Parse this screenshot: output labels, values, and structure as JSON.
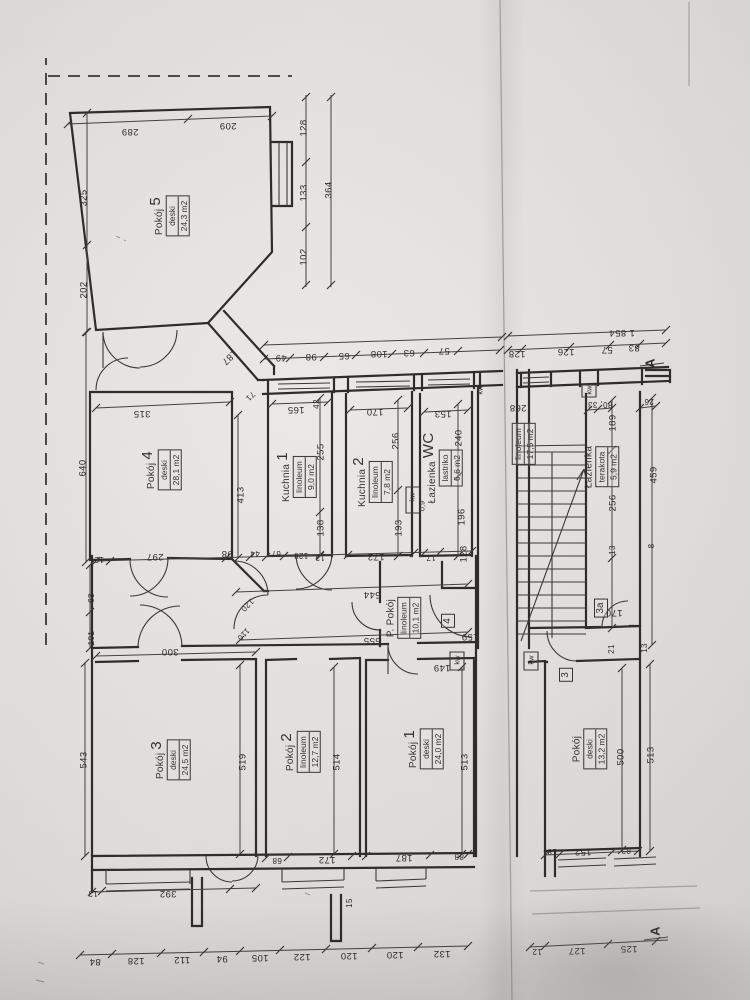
{
  "document": {
    "kind": "scanned apartment floor plan",
    "section_marker": "A",
    "total_length_label": "1 854",
    "ink_color": "#34322f",
    "paper_color": "#dbd9d7"
  },
  "rooms": [
    {
      "id": "pokoj-5",
      "name": "Pokój",
      "number": "5",
      "floor": "deski",
      "area": "24,3 m2",
      "x": 170,
      "y": 216
    },
    {
      "id": "pokoj-4",
      "name": "Pokój",
      "number": "4",
      "floor": "deski",
      "area": "28,1 m2",
      "x": 162,
      "y": 470
    },
    {
      "id": "kuchnia-1",
      "name": "Kuchnia",
      "number": "1",
      "floor": "linoleum",
      "area": "9,0 m2",
      "x": 297,
      "y": 477
    },
    {
      "id": "kuchnia-2",
      "name": "Kuchnia",
      "number": "2",
      "floor": "linoleum",
      "area": "7,8 m2",
      "x": 373,
      "y": 482
    },
    {
      "id": "lazienka-wc",
      "name": "Łazienka",
      "number": "WC",
      "floor": "lastriko",
      "area": "6,6 m2",
      "x": 443,
      "y": 468
    },
    {
      "id": "p-pokoj",
      "name": "P. Pokój",
      "number": "",
      "floor": "linoleum",
      "area": "10,1 m2",
      "x": 404,
      "y": 618
    },
    {
      "id": "pokoj-3",
      "name": "Pokój",
      "number": "3",
      "floor": "deski",
      "area": "24,5 m2",
      "x": 171,
      "y": 760
    },
    {
      "id": "pokoj-2",
      "name": "Pokój",
      "number": "2",
      "floor": "linoleum",
      "area": "12,7 m2",
      "x": 301,
      "y": 752
    },
    {
      "id": "pokoj-1",
      "name": "Pokój",
      "number": "1",
      "floor": "deski",
      "area": "24,0 m2",
      "x": 424,
      "y": 749
    },
    {
      "id": "klatka",
      "name": "",
      "number": "",
      "floor": "linoleum",
      "area": "17,5 m2",
      "x": 524,
      "y": 444
    },
    {
      "id": "lazienka-terakota",
      "name": "Łazienka",
      "number": "",
      "floor": "terakota",
      "area": "5,9 m2",
      "x": 602,
      "y": 467
    },
    {
      "id": "pokoj-parter",
      "name": "Pokój",
      "number": "",
      "floor": "deski",
      "area": "13,2 m2",
      "x": 590,
      "y": 749
    }
  ],
  "unit_markers": [
    {
      "t": "4",
      "x": 448,
      "y": 621
    },
    {
      "t": "3",
      "x": 566,
      "y": 675
    },
    {
      "t": "3a",
      "x": 601,
      "y": 608
    }
  ],
  "section_markers": [
    {
      "t": "A",
      "x": 650,
      "y": 363
    },
    {
      "t": "A",
      "x": 655,
      "y": 931
    }
  ],
  "shaft_labels": [
    {
      "t": "kw",
      "x": 412,
      "y": 497
    },
    {
      "t": "0,9",
      "x": 422,
      "y": 506
    },
    {
      "t": "kw",
      "x": 480,
      "y": 390
    },
    {
      "t": "kw",
      "x": 457,
      "y": 660
    },
    {
      "t": "kw",
      "x": 531,
      "y": 660
    },
    {
      "t": "kw",
      "x": 589,
      "y": 390
    }
  ],
  "dims": [
    {
      "t": "289",
      "x": 130,
      "y": 131,
      "o": "u"
    },
    {
      "t": "209",
      "x": 228,
      "y": 125,
      "o": "u"
    },
    {
      "t": "128",
      "x": 304,
      "y": 128,
      "o": "v"
    },
    {
      "t": "133",
      "x": 304,
      "y": 193,
      "o": "v"
    },
    {
      "t": "102",
      "x": 304,
      "y": 257,
      "o": "v"
    },
    {
      "t": "364",
      "x": 329,
      "y": 190,
      "o": "v"
    },
    {
      "t": "325",
      "x": 84,
      "y": 198,
      "o": "v"
    },
    {
      "t": "202",
      "x": 84,
      "y": 290,
      "o": "v"
    },
    {
      "t": "315",
      "x": 142,
      "y": 413,
      "o": "u"
    },
    {
      "t": "640",
      "x": 83,
      "y": 468,
      "o": "v"
    },
    {
      "t": "413",
      "x": 241,
      "y": 495,
      "o": "v"
    },
    {
      "t": "187",
      "x": 229,
      "y": 357,
      "o": "d"
    },
    {
      "t": "71",
      "x": 250,
      "y": 396,
      "o": "d",
      "s": 1
    },
    {
      "t": "297",
      "x": 155,
      "y": 556,
      "o": "u"
    },
    {
      "t": "98",
      "x": 227,
      "y": 553,
      "o": "u"
    },
    {
      "t": "12",
      "x": 99,
      "y": 559,
      "o": "u",
      "s": 1
    },
    {
      "t": "49",
      "x": 281,
      "y": 357,
      "o": "u"
    },
    {
      "t": "98",
      "x": 311,
      "y": 356,
      "o": "u"
    },
    {
      "t": "65",
      "x": 344,
      "y": 355,
      "o": "u"
    },
    {
      "t": "108",
      "x": 379,
      "y": 353,
      "o": "u"
    },
    {
      "t": "63",
      "x": 409,
      "y": 352,
      "o": "u"
    },
    {
      "t": "57",
      "x": 444,
      "y": 350,
      "o": "u"
    },
    {
      "t": "165",
      "x": 296,
      "y": 409,
      "o": "u"
    },
    {
      "t": "42",
      "x": 317,
      "y": 404,
      "o": "v",
      "s": 1
    },
    {
      "t": "255",
      "x": 321,
      "y": 452,
      "o": "v"
    },
    {
      "t": "138",
      "x": 321,
      "y": 528,
      "o": "v"
    },
    {
      "t": "170",
      "x": 375,
      "y": 411,
      "o": "u"
    },
    {
      "t": "256",
      "x": 396,
      "y": 441,
      "o": "v"
    },
    {
      "t": "193",
      "x": 399,
      "y": 528,
      "o": "v"
    },
    {
      "t": "153",
      "x": 443,
      "y": 413,
      "o": "u"
    },
    {
      "t": "240",
      "x": 459,
      "y": 438,
      "o": "v"
    },
    {
      "t": "196",
      "x": 462,
      "y": 517,
      "o": "v"
    },
    {
      "t": "44",
      "x": 255,
      "y": 553,
      "o": "u",
      "s": 1
    },
    {
      "t": "67",
      "x": 276,
      "y": 553,
      "o": "u",
      "s": 1
    },
    {
      "t": "128",
      "x": 301,
      "y": 555,
      "o": "u",
      "s": 1
    },
    {
      "t": "13",
      "x": 320,
      "y": 557,
      "o": "u",
      "s": 1
    },
    {
      "t": "172",
      "x": 376,
      "y": 556,
      "o": "u"
    },
    {
      "t": "17",
      "x": 431,
      "y": 557,
      "o": "u",
      "s": 1
    },
    {
      "t": "128",
      "x": 464,
      "y": 554,
      "o": "v"
    },
    {
      "t": "544",
      "x": 372,
      "y": 594,
      "o": "u"
    },
    {
      "t": "555",
      "x": 372,
      "y": 640,
      "o": "u"
    },
    {
      "t": "159",
      "x": 470,
      "y": 636,
      "o": "u"
    },
    {
      "t": "149",
      "x": 442,
      "y": 667,
      "o": "u"
    },
    {
      "t": "300",
      "x": 170,
      "y": 651,
      "o": "u"
    },
    {
      "t": "63",
      "x": 92,
      "y": 598,
      "o": "v",
      "s": 1
    },
    {
      "t": "101",
      "x": 92,
      "y": 638,
      "o": "v",
      "s": 1
    },
    {
      "t": "543",
      "x": 84,
      "y": 760,
      "o": "v"
    },
    {
      "t": "519",
      "x": 243,
      "y": 762,
      "o": "v"
    },
    {
      "t": "514",
      "x": 337,
      "y": 762,
      "o": "v"
    },
    {
      "t": "513",
      "x": 465,
      "y": 762,
      "o": "v"
    },
    {
      "t": "120",
      "x": 247,
      "y": 605,
      "o": "d",
      "s": 1
    },
    {
      "t": "110",
      "x": 243,
      "y": 634,
      "o": "d",
      "s": 1
    },
    {
      "t": "392",
      "x": 168,
      "y": 893,
      "o": "u"
    },
    {
      "t": "13",
      "x": 93,
      "y": 893,
      "o": "u",
      "s": 1
    },
    {
      "t": "172",
      "x": 327,
      "y": 859,
      "o": "u"
    },
    {
      "t": "68",
      "x": 277,
      "y": 860,
      "o": "u",
      "s": 1
    },
    {
      "t": "187",
      "x": 404,
      "y": 857,
      "o": "u"
    },
    {
      "t": "88",
      "x": 459,
      "y": 856,
      "o": "u",
      "s": 1
    },
    {
      "t": "15",
      "x": 350,
      "y": 903,
      "o": "v",
      "s": 1
    },
    {
      "t": "84",
      "x": 95,
      "y": 961,
      "o": "u"
    },
    {
      "t": "128",
      "x": 136,
      "y": 960,
      "o": "u"
    },
    {
      "t": "112",
      "x": 182,
      "y": 959,
      "o": "u"
    },
    {
      "t": "94",
      "x": 222,
      "y": 958,
      "o": "u"
    },
    {
      "t": "105",
      "x": 260,
      "y": 957,
      "o": "u"
    },
    {
      "t": "122",
      "x": 302,
      "y": 956,
      "o": "u"
    },
    {
      "t": "120",
      "x": 349,
      "y": 955,
      "o": "u"
    },
    {
      "t": "120",
      "x": 395,
      "y": 954,
      "o": "u"
    },
    {
      "t": "132",
      "x": 442,
      "y": 953,
      "o": "u"
    },
    {
      "t": "128",
      "x": 517,
      "y": 353,
      "o": "u"
    },
    {
      "t": "126",
      "x": 566,
      "y": 351,
      "o": "u"
    },
    {
      "t": "57",
      "x": 607,
      "y": 349,
      "o": "u"
    },
    {
      "t": "83",
      "x": 634,
      "y": 347,
      "o": "u"
    },
    {
      "t": "1 854",
      "x": 622,
      "y": 332,
      "o": "u"
    },
    {
      "t": "268",
      "x": 518,
      "y": 407,
      "o": "u"
    },
    {
      "t": "80, 33",
      "x": 600,
      "y": 404,
      "o": "u",
      "s": 1
    },
    {
      "t": "26",
      "x": 649,
      "y": 401,
      "o": "u",
      "s": 1
    },
    {
      "t": "189",
      "x": 613,
      "y": 423,
      "o": "v"
    },
    {
      "t": "459",
      "x": 654,
      "y": 475,
      "o": "v"
    },
    {
      "t": "256",
      "x": 613,
      "y": 503,
      "o": "v"
    },
    {
      "t": "13",
      "x": 613,
      "y": 550,
      "o": "v",
      "s": 1
    },
    {
      "t": "8",
      "x": 652,
      "y": 546,
      "o": "v",
      "s": 1
    },
    {
      "t": "170",
      "x": 614,
      "y": 612,
      "o": "u"
    },
    {
      "t": "21",
      "x": 612,
      "y": 649,
      "o": "v",
      "s": 1
    },
    {
      "t": "13",
      "x": 645,
      "y": 648,
      "o": "v",
      "s": 1
    },
    {
      "t": "500",
      "x": 621,
      "y": 757,
      "o": "v"
    },
    {
      "t": "513",
      "x": 651,
      "y": 755,
      "o": "v"
    },
    {
      "t": "18",
      "x": 552,
      "y": 851,
      "o": "u",
      "s": 1
    },
    {
      "t": "152",
      "x": 583,
      "y": 851,
      "o": "u"
    },
    {
      "t": "83",
      "x": 626,
      "y": 850,
      "o": "u",
      "s": 1
    },
    {
      "t": "12",
      "x": 537,
      "y": 951,
      "o": "u",
      "s": 1
    },
    {
      "t": "127",
      "x": 577,
      "y": 950,
      "o": "u"
    },
    {
      "t": "125",
      "x": 629,
      "y": 948,
      "o": "u"
    }
  ]
}
